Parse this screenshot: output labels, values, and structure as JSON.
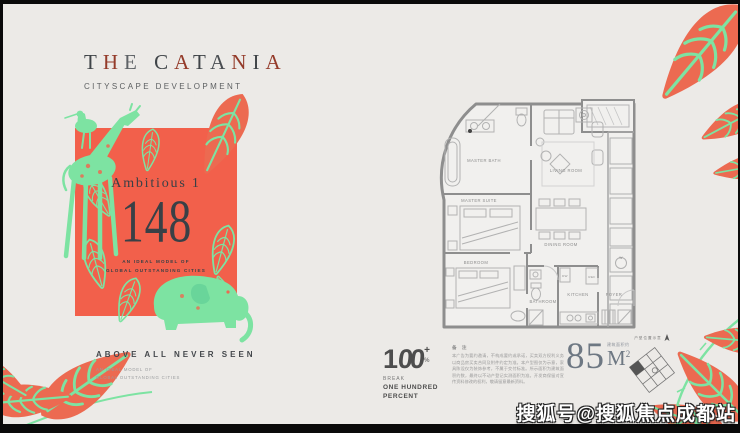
{
  "colors": {
    "background": "#ECEAE7",
    "coral": "#F2604B",
    "mint": "#7DE3A2",
    "leaf_coral": "#EC6A51",
    "ink": "#3F4448",
    "brand_red": "#943B2A",
    "plan_line": "#8E8E8E"
  },
  "brand": {
    "title": "THE CATANIA",
    "title_letters": [
      {
        "ch": "T",
        "c": "#3F4448"
      },
      {
        "ch": "H",
        "c": "#943B2A"
      },
      {
        "ch": "E",
        "c": "#5E6266"
      },
      {
        "ch": " ",
        "c": "#3F4448"
      },
      {
        "ch": "C",
        "c": "#3F4448"
      },
      {
        "ch": "A",
        "c": "#943B2A"
      },
      {
        "ch": "T",
        "c": "#3F4448"
      },
      {
        "ch": "A",
        "c": "#4a4e52"
      },
      {
        "ch": "N",
        "c": "#943B2A"
      },
      {
        "ch": "I",
        "c": "#3F4448"
      },
      {
        "ch": "A",
        "c": "#943B2A"
      }
    ],
    "subtitle": "CITYSCAPE DEVELOPMENT"
  },
  "poster": {
    "headline": "Ambitious 1",
    "number": "148",
    "caption1": "AN IDEAL MODEL OF",
    "caption2": "GLOBAL OUTSTANDING CITIES"
  },
  "tagline": {
    "title": "ABOVE ALL NEVER SEEN",
    "line1": "AN IDEAL MODEL OF",
    "line2": "GLOBAL OUTSTANDING CITIES"
  },
  "floorplan": {
    "rooms": [
      "MASTER BATH",
      "LIVING ROOM",
      "MASTER SUITE",
      "BEDROOM",
      "DINING ROOM",
      "BATHROOM",
      "KITCHEN",
      "FOYER"
    ],
    "appliances": [
      "W",
      "DW",
      "REF"
    ]
  },
  "footer": {
    "logo": {
      "number1": "1",
      "loops": "00",
      "plus": "+",
      "percent": "%",
      "tag": "BREAK",
      "line1": "ONE HUNDRED",
      "line2": "PERCENT"
    },
    "note_label": "备 注",
    "disclaimer": "本广告为要约邀请，不构成要约或承诺，买卖双方权利义务以商品房买卖合同及附件约定为准。本户型图仅为示意，家具陈设仅为装饰参考，不属于交付标准。所示面积为建筑面积约数，最终以不动产登记实测面积为准。开发商保留对宣传资料修改的权利，敬请留意最新资料。",
    "area": {
      "value": "85",
      "unit": "M",
      "sup": "2",
      "label": "建筑面积约"
    },
    "keyplan": {
      "label": "户型位置示意"
    }
  },
  "watermark": "搜狐号@搜狐焦点成都站"
}
